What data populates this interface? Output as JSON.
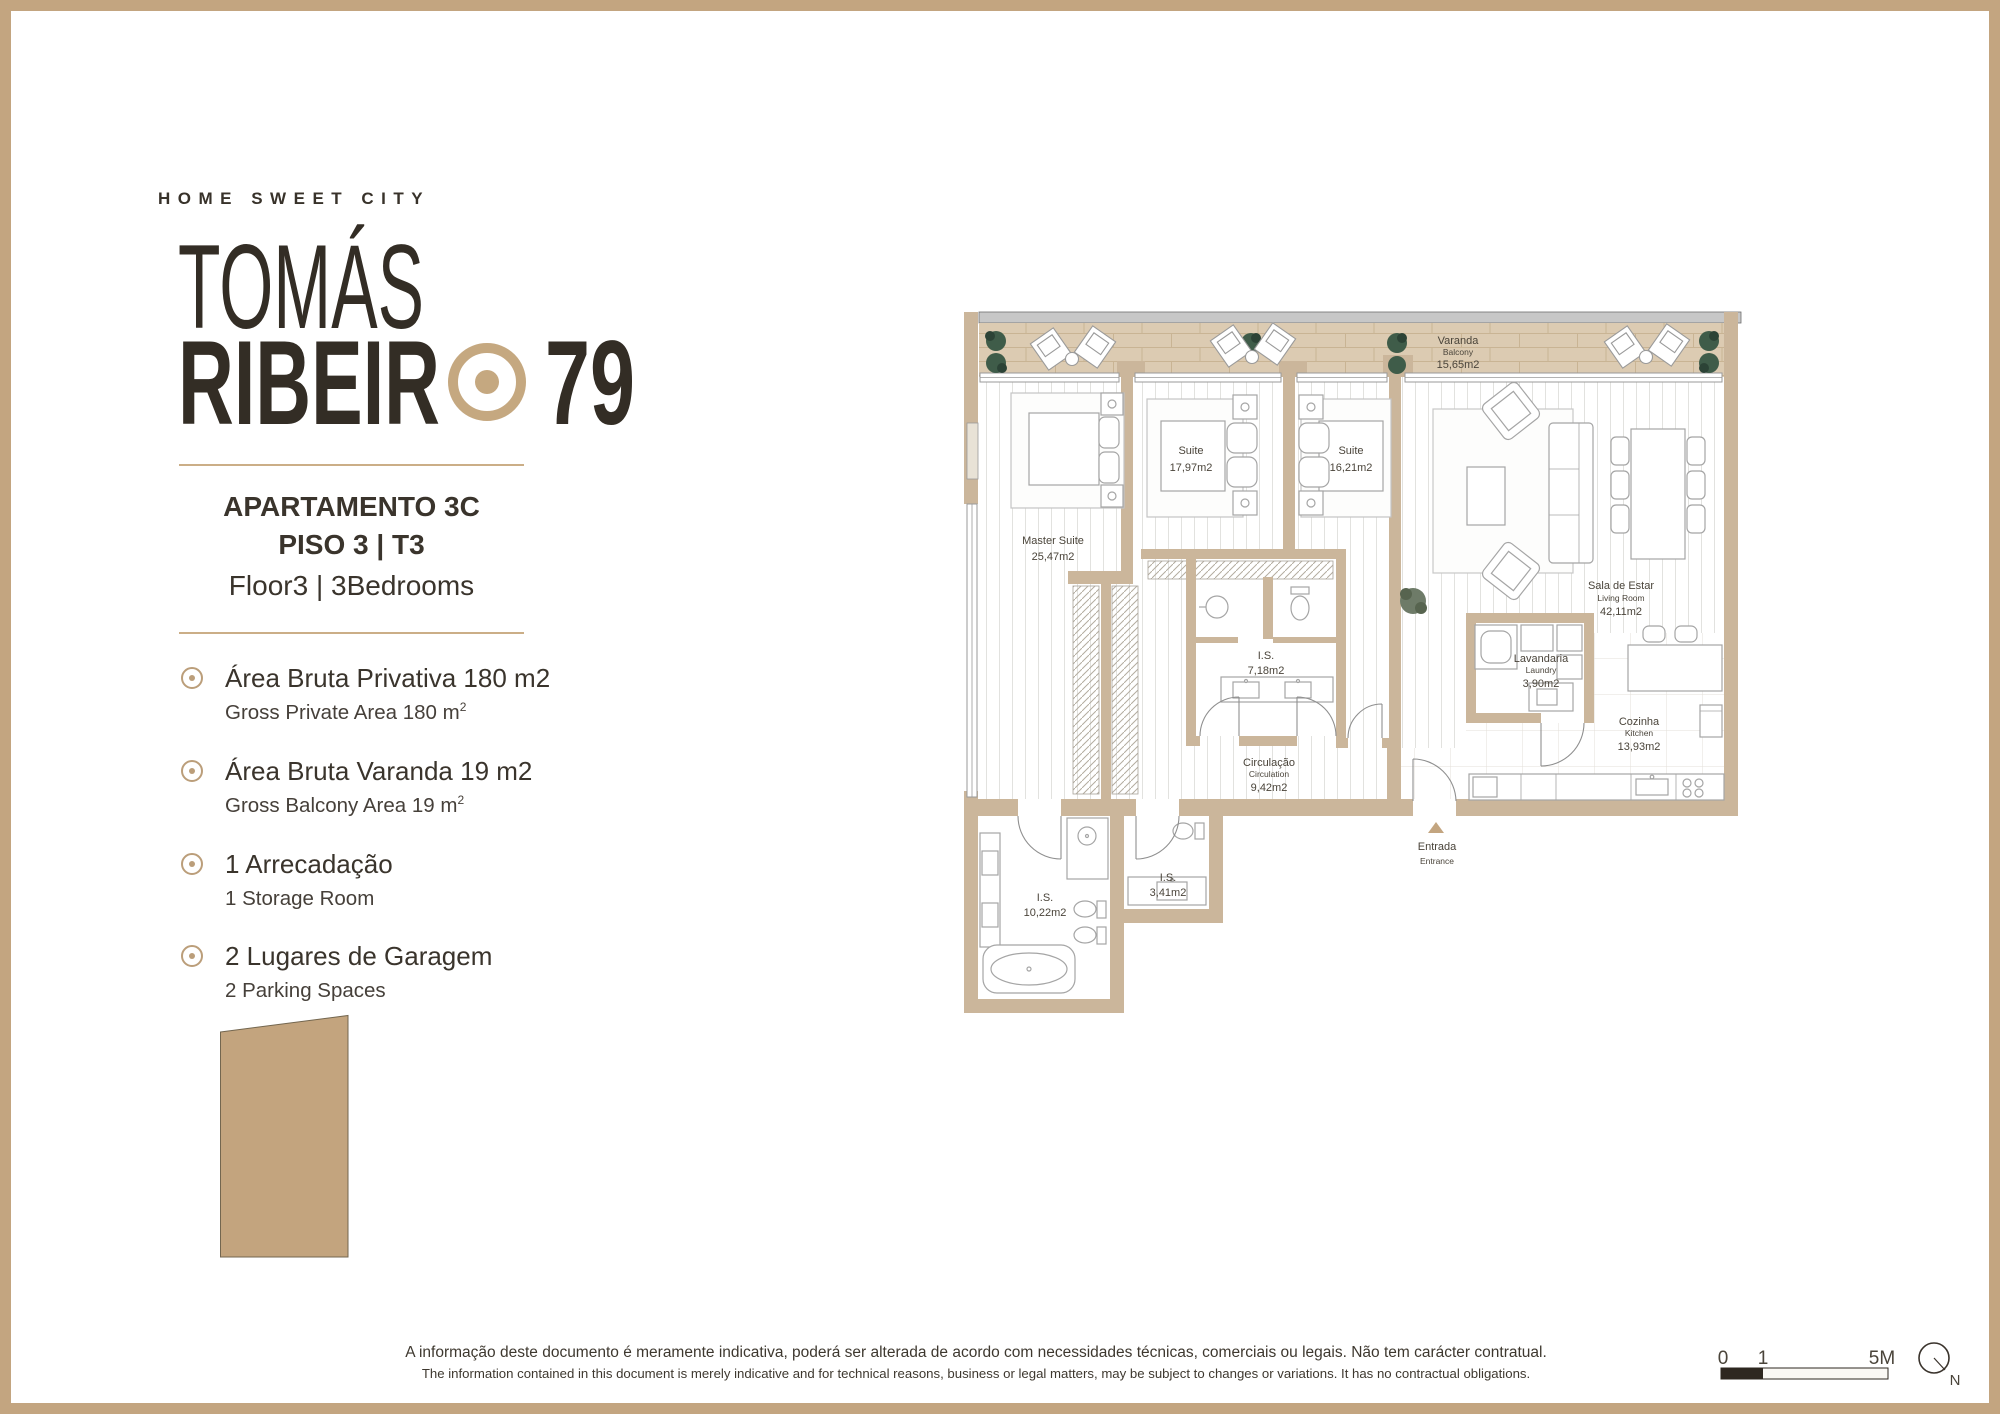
{
  "brand": {
    "tagline": "HOME SWEET CITY",
    "name_top": "TOMÁS",
    "name_bottom": "RIBEIR",
    "number": "79"
  },
  "apartment": {
    "line1": "APARTAMENTO 3C",
    "line2": "PISO 3 | T3",
    "line3": "Floor3 | 3Bedrooms"
  },
  "features": [
    {
      "pt": "Área Bruta Privativa 180 m2",
      "en": "Gross Private Area 180 m",
      "en_sup": "2"
    },
    {
      "pt": "Área Bruta Varanda 19 m2",
      "en": "Gross Balcony Area 19 m",
      "en_sup": "2"
    },
    {
      "pt": "1 Arrecadação",
      "en": "1 Storage Room",
      "en_sup": ""
    },
    {
      "pt": "2 Lugares de Garagem",
      "en": "2 Parking Spaces",
      "en_sup": ""
    }
  ],
  "plan": {
    "varanda": {
      "pt": "Varanda",
      "en": "Balcony",
      "area": "15,65m2"
    },
    "suite1": {
      "pt": "Suite",
      "area": "17,97m2"
    },
    "suite2": {
      "pt": "Suite",
      "area": "16,21m2"
    },
    "master": {
      "pt": "Master Suite",
      "area": "25,47m2"
    },
    "living": {
      "pt": "Sala de Estar",
      "en": "Living Room",
      "area": "42,11m2"
    },
    "is_main": {
      "pt": "I.S.",
      "area": "7,18m2"
    },
    "laundry": {
      "pt": "Lavandaria",
      "en": "Laundry",
      "area": "3,90m2"
    },
    "kitchen": {
      "pt": "Cozinha",
      "en": "Kitchen",
      "area": "13,93m2"
    },
    "circulation": {
      "pt": "Circulação",
      "en": "Circulation",
      "area": "9,42m2"
    },
    "is_small": {
      "pt": "I.S.",
      "area": "3,41m2"
    },
    "is_master": {
      "pt": "I.S.",
      "area": "10,22m2"
    },
    "entrance": {
      "pt": "Entrada",
      "en": "Entrance"
    }
  },
  "footer": {
    "disclaimer_pt": "A informação deste documento é meramente indicativa, poderá ser alterada de acordo com necessidades técnicas, comerciais ou legais. Não tem carácter contratual.",
    "disclaimer_en": "The information contained in this document is merely indicative and for technical reasons, business or legal matters, may be subject to changes or variations. It has no contractual obligations."
  },
  "scalebar": {
    "t0": "0",
    "t1": "1",
    "t5": "5M",
    "north": "N"
  },
  "colors": {
    "accent_tan": "#c3a580",
    "wall_tan": "#cbb69b",
    "balcony_floor": "#dccbb2",
    "plant_green": "#3f5c49",
    "ink": "#352f28"
  }
}
